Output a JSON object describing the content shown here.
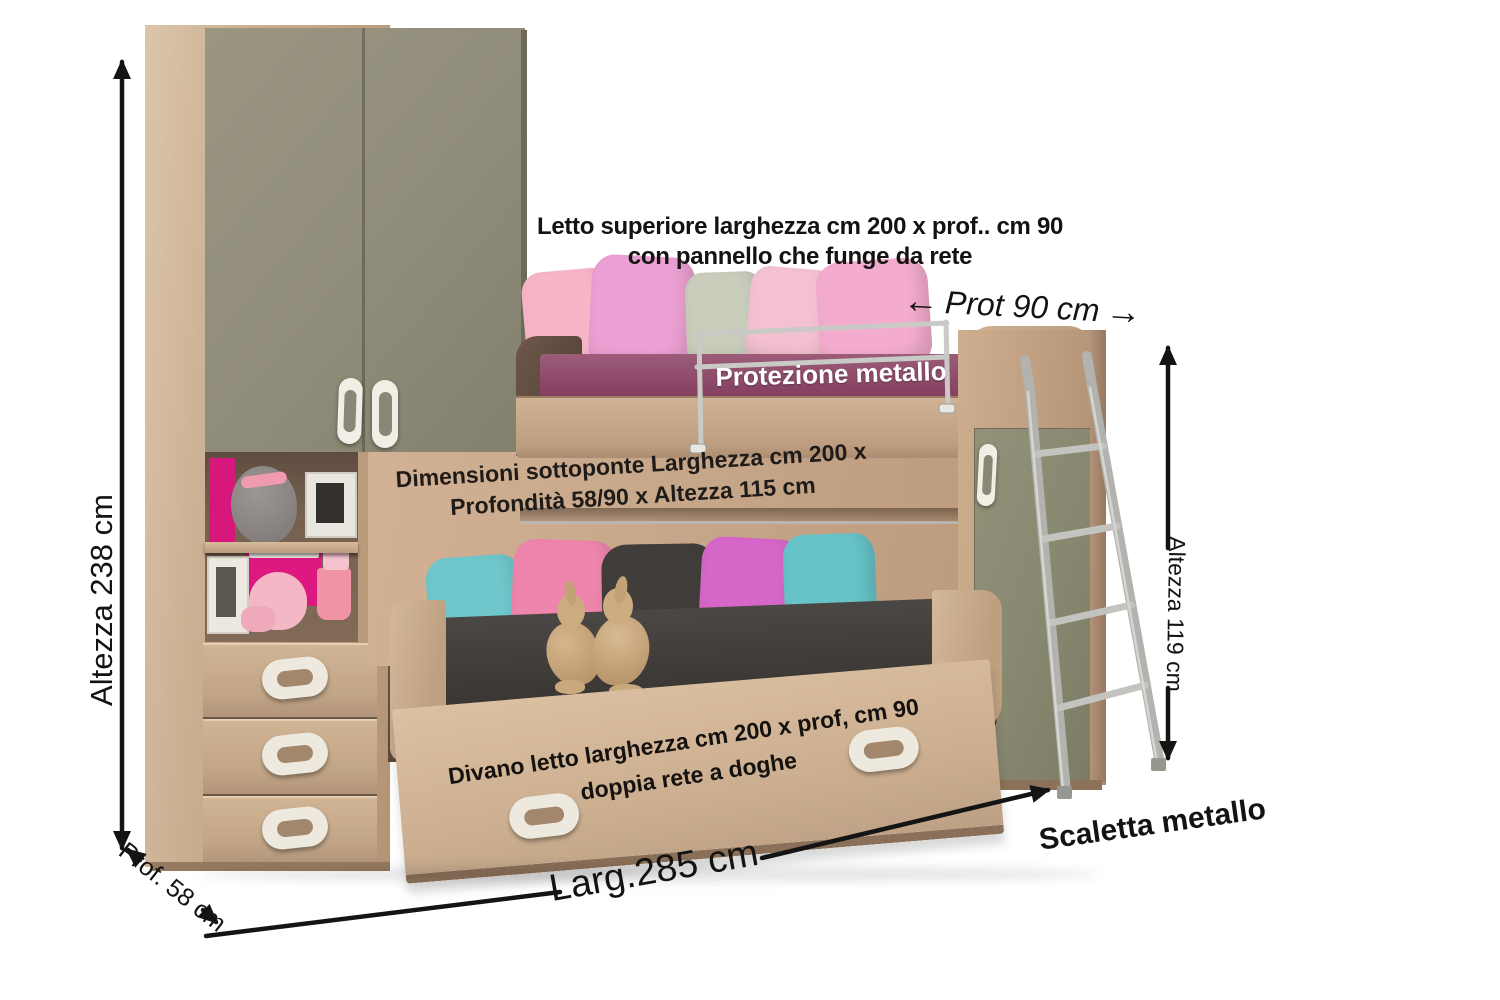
{
  "annotations": {
    "upper_bed": {
      "line1": "Letto superiore larghezza cm 200 x prof.. cm 90",
      "line2": "con pannello che funge da rete"
    },
    "upper_depth": {
      "label": "Prot 90 cm",
      "arrow_left": "←",
      "arrow_right": "→"
    },
    "guard_rail": {
      "label": "Protezione metallo"
    },
    "under_bunk": {
      "line1": "Dimensioni sottoponte Larghezza cm 200 x",
      "line2": "Profondità 58/90 x Altezza 115 cm"
    },
    "total_height": {
      "label": "Altezza 238 cm"
    },
    "ladder_height": {
      "label": "Altezza 119 cm"
    },
    "sofa_bed": {
      "line1": "Divano letto larghezza cm 200 x prof, cm 90",
      "line2": "doppia rete a doghe"
    },
    "total_width": {
      "label": "Larg.285 cm"
    },
    "wardrobe_depth": {
      "label": "Prof. 58 cm"
    },
    "ladder": {
      "label": "Scaletta metallo"
    }
  },
  "palette": {
    "wood": "#c7a88b",
    "wood_dark": "#8a7058",
    "door_olive": "#8d8a78",
    "mattress_purple": "#8e4a68",
    "sofa_charcoal": "#3d3935",
    "pillow_pink": "#f3accd",
    "pillow_orchid": "#eaa0d2",
    "pillow_teal": "#6fc7cb",
    "pillow_magenta": "#d666c8",
    "niche_magenta": "#dd1880",
    "metal": "#c0c0bd",
    "dimension_lines": "#141414"
  }
}
